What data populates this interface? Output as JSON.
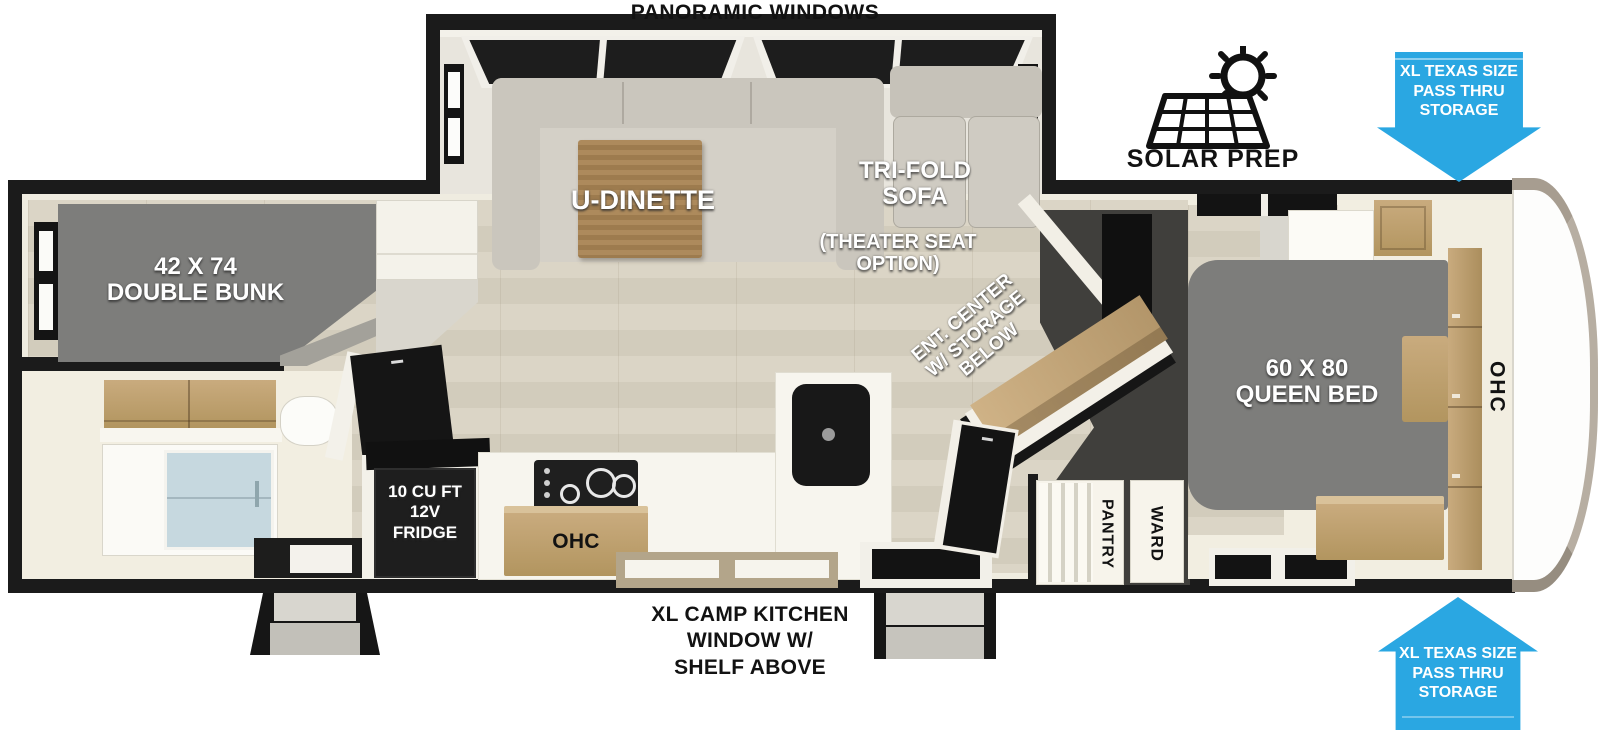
{
  "title": {
    "top": "PANORAMIC WINDOWS"
  },
  "callouts": {
    "solar_prep": "SOLAR PREP",
    "pass_thru_storage": [
      "XL TEXAS SIZE",
      "PASS THRU",
      "STORAGE"
    ],
    "camp_kitchen": [
      "XL CAMP KITCHEN",
      "WINDOW W/",
      "SHELF ABOVE"
    ]
  },
  "living_area": {
    "dinette": "U-DINETTE",
    "sofa": [
      "TRI-FOLD",
      "SOFA"
    ],
    "sofa_option": [
      "(THEATER SEAT",
      "OPTION)"
    ],
    "ent_center": [
      "ENT. CENTER",
      "W/ STORAGE",
      "BELOW"
    ]
  },
  "kitchen": {
    "fridge": [
      "10 CU FT",
      "12V",
      "FRIDGE"
    ],
    "overhead_cabinet": "OHC"
  },
  "bunk_room": {
    "bed": [
      "42 X 74",
      "DOUBLE BUNK"
    ]
  },
  "bedroom": {
    "bed": [
      "60 X 80",
      "QUEEN BED"
    ],
    "overhead_cabinet": "OHC",
    "pantry": "PANTRY",
    "wardrobe": "WARD"
  },
  "colors": {
    "arrow_blue": "#2aa7e2",
    "wall_black": "#1b1b1b",
    "divider_charcoal": "#403f3c",
    "floor_tan": "#d7d0c1",
    "interior_cream": "#f2eee1",
    "cabinet_wood": "#bda077",
    "mattress_gray": "#7d7d7b",
    "sofa_gray": "#cac6bd",
    "shower_glass_blue": "#c6d8df"
  }
}
